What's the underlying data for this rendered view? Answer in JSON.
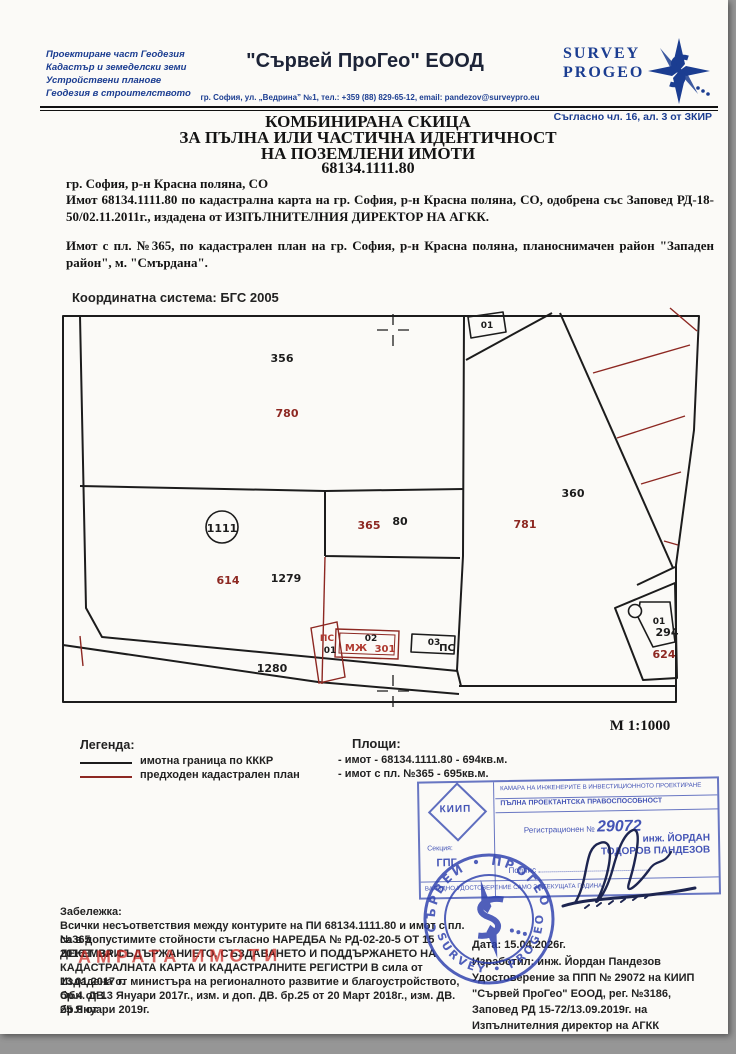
{
  "header": {
    "services": [
      "Проектиране част Геодезия",
      "Кадастър и земеделски земи",
      "Устройствени планове",
      "Геодезия в строителството"
    ],
    "company_name": "\"Сървей ПроГео\" ЕООД",
    "address": "гр. София, ул. „Ведрина” №1, тел.: +359 (88) 829-65-12, email: pandezov@surveypro.eu",
    "logo_line1": "SURVEY",
    "logo_line2": "PROGEO",
    "legal_ref": "Съгласно чл. 16, ал. 3 от ЗКИР",
    "brand_color": "#1b3d91"
  },
  "title": {
    "line1": "КОМБИНИРАНА СКИЦА",
    "line2": "ЗА ПЪЛНА ИЛИ ЧАСТИЧНА ИДЕНТИЧНОСТ",
    "line3": "НА ПОЗЕМЛЕНИ ИМОТИ",
    "id": "68134.1111.80"
  },
  "intro": {
    "location": "гр. София, р-н Красна поляна, СО",
    "p1": "Имот 68134.1111.80 по кадастрална карта на гр. София, р-н Красна поляна, СО, одобрена със Заповед РД-18-50/02.11.2011г., издадена от ИЗПЪЛНИТЕЛНИЯ ДИРЕКТОР НА АГКК.",
    "p2": "Имот с пл. №365, по кадастрален план на гр. София, р-н Красна поляна, планоснимачен район \"Западен район\", м. \"Смърдана\"."
  },
  "map": {
    "coordinate_system": "Координатна система: БГС 2005",
    "scale": "М 1:1000",
    "line_black": "#1c1c1c",
    "line_red": "#8d2822",
    "labels": {
      "p356": "356",
      "p780": "780",
      "p1111": "1111",
      "p614": "614",
      "p1279": "1279",
      "p365": "365",
      "p80": "80",
      "p781": "781",
      "p360": "360",
      "p1280": "1280",
      "p294": "294",
      "p624": "624",
      "b01_top": "01",
      "b01_small": "01",
      "b_ps1": "ПС",
      "b_ps1_no": "01",
      "b_mzh": "МЖ",
      "b_mzh_no": "02",
      "b_301": "301",
      "b_03": "03",
      "b_ps2": "ПС"
    }
  },
  "legend": {
    "title": "Легенда:",
    "items": [
      {
        "label": "имотна граница по КККР",
        "color": "#1c1c1c"
      },
      {
        "label": "предходен кадастрален план",
        "color": "#8d2822"
      }
    ]
  },
  "areas": {
    "title": "Площи:",
    "items": [
      "- имот   - 68134.1111.80 - 694кв.м.",
      "- имот с пл. №365 - 695кв.м."
    ]
  },
  "stamp": {
    "org": "КАМАРА НА ИНЖЕНЕРИТЕ В ИНВЕСТИЦИОННОТО ПРОЕКТИРАНЕ",
    "qualification": "ПЪЛНА ПРОЕКТАНТСКА ПРАВОСПОСОБНОСТ",
    "reg_label": "Регистрационен №",
    "reg_number": "29072",
    "name_line1": "инж. ЙОРДАН",
    "name_line2": "ТОДОРОВ ПАНДЕЗОВ",
    "section_label": "Секция:",
    "section": "ГПГ",
    "logo": "КИИП",
    "signature_label": "Подпис",
    "validity": "ВАЛИДНО УДОСТОВЕРЕНИЕ САМО ЗА ТЕКУЩАТА ГОДИНА",
    "color": "#2b3ead"
  },
  "round_stamp": {
    "ring_top": "СЪРВЕЙ • ПРОГЕО",
    "ring_bottom": "SURVEY • PROGEO"
  },
  "red_stamp_text": "АМРАТА ИМОТИ",
  "note": {
    "title": "Забележка:",
    "lines": [
      "Всички несъответствия между контурите на ПИ 68134.1111.80 и имот с пл. №365",
      "са в допустимите стойности съгласно НАРЕДБА № РД-02-20-5 ОТ 15 ДЕКЕМВРИ",
      "2016 Г. ЗА СЪДЪРЖАНИЕТО, СЪЗДАВАНЕТО И ПОДДЪРЖАНЕТО НА",
      "КАДАСТРАЛНАТА КАРТА И КАДАСТРАЛНИТЕ РЕГИСТРИ В сила от 13.01.2017 г.",
      "Издадена от министъра на регионалното развитие и благоустройството, Обн. ДВ.",
      "бр.4 от 13 Януари 2017г., изм. и доп. ДВ. бр.25 от 20 Март 2018г., изм. ДВ. бр.8 от",
      "25 Януари 2019г."
    ]
  },
  "footer": {
    "date": "Дата: 15.04.2026г.",
    "author": "Изработил: инж. Йордан Пандезов",
    "cert": "Удостоверение за ППП № 29072 на КИИП",
    "company_reg": "\"Сървей ПроГео\" ЕООД, рег. №3186,",
    "order": "Заповед РД 15-72/13.09.2019г. на",
    "director": "Изпълнителния директор на АГКК"
  }
}
